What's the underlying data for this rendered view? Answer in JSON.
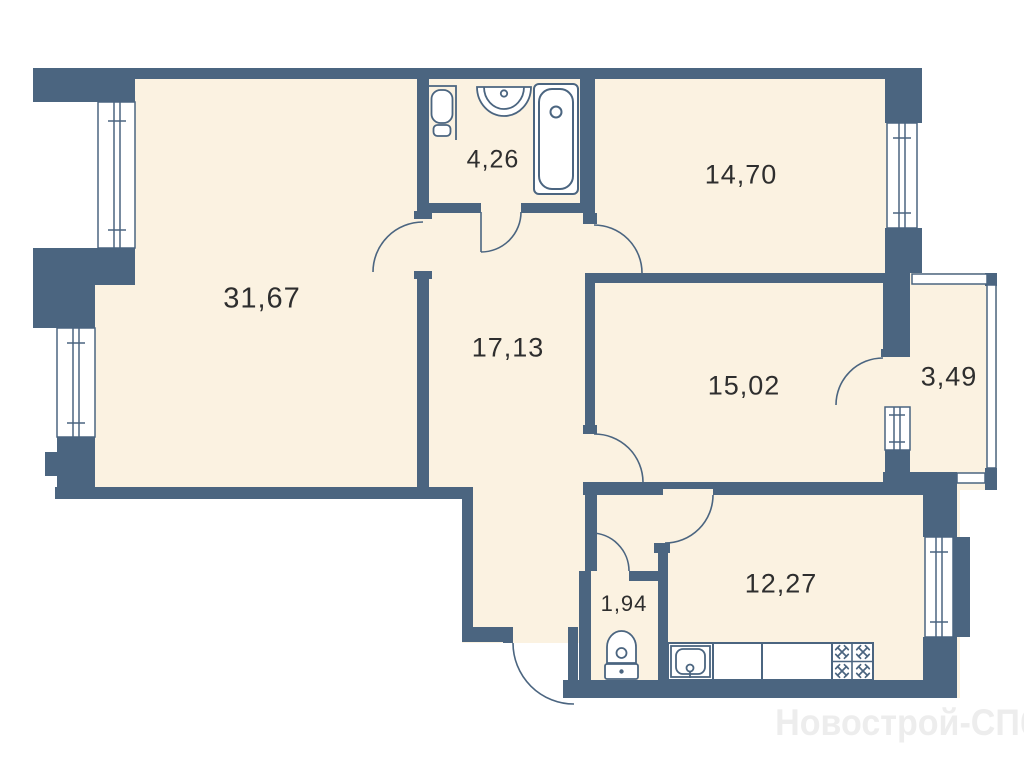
{
  "plan": {
    "title": "apartment-floor-plan",
    "watermark": "Новострой-СПб",
    "rooms": [
      {
        "id": "living-room",
        "area": "31,67"
      },
      {
        "id": "hallway",
        "area": "17,13"
      },
      {
        "id": "bathroom",
        "area": "4,26"
      },
      {
        "id": "bedroom-top",
        "area": "14,70"
      },
      {
        "id": "bedroom-mid",
        "area": "15,02"
      },
      {
        "id": "balcony",
        "area": "3,49"
      },
      {
        "id": "wc",
        "area": "1,94"
      },
      {
        "id": "kitchen",
        "area": "12,27"
      }
    ],
    "fixtures": {
      "bathroom": [
        "toilet-icon",
        "sink-icon",
        "bathtub-icon"
      ],
      "wc": [
        "toilet-icon"
      ],
      "kitchen": [
        "kitchen-sink-icon",
        "countertop-icon",
        "stove-burners-icon"
      ]
    },
    "colors": {
      "wall": "#4B6580",
      "room_fill": "#FBF2E1",
      "background": "#FFFFFF",
      "label_text": "#2E2E2E",
      "watermark": "#EDEDED"
    }
  }
}
